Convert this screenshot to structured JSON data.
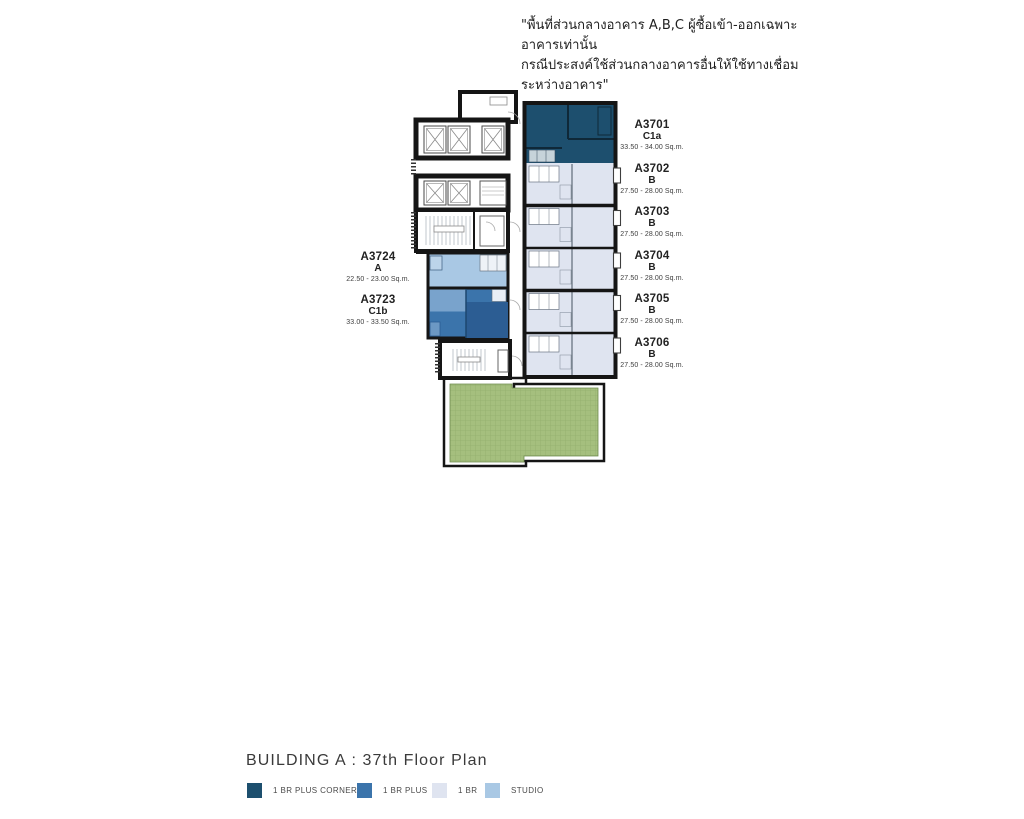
{
  "disclaimer": {
    "line1": "\"พื้นที่ส่วนกลางอาคาร A,B,C ผู้ซื้อเข้า-ออกเฉพาะอาคารเท่านั้น",
    "line2": "กรณีประสงค์ใช้ส่วนกลางอาคารอื่นให้ใช้ทางเชื่อมระหว่างอาคาร\""
  },
  "plan": {
    "building": "A",
    "floor": "37th",
    "title": "BUILDING A : 37th  Floor Plan"
  },
  "legend": [
    {
      "label": "1 BR PLUS CORNER",
      "color": "#1d4f6e"
    },
    {
      "label": "1 BR PLUS",
      "color": "#3b74ab"
    },
    {
      "label": "1 BR",
      "color": "#dfe4f0"
    },
    {
      "label": "STUDIO",
      "color": "#a9c8e4"
    }
  ],
  "colors": {
    "wall": "#151515",
    "terrace_green": "#a5bf7e"
  },
  "units_right": [
    {
      "id": "A3701",
      "type": "C1a",
      "area": "33.50 - 34.00 Sq.m."
    },
    {
      "id": "A3702",
      "type": "B",
      "area": "27.50 - 28.00 Sq.m."
    },
    {
      "id": "A3703",
      "type": "B",
      "area": "27.50 - 28.00 Sq.m."
    },
    {
      "id": "A3704",
      "type": "B",
      "area": "27.50 - 28.00 Sq.m."
    },
    {
      "id": "A3705",
      "type": "B",
      "area": "27.50 - 28.00 Sq.m."
    },
    {
      "id": "A3706",
      "type": "B",
      "area": "27.50 - 28.00 Sq.m."
    }
  ],
  "units_left": [
    {
      "id": "A3724",
      "type": "A",
      "area": "22.50 - 23.00 Sq.m."
    },
    {
      "id": "A3723",
      "type": "C1b",
      "area": "33.00 - 33.50 Sq.m."
    }
  ]
}
